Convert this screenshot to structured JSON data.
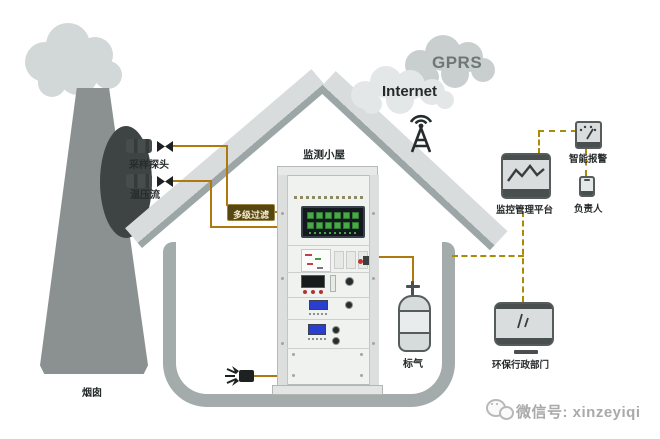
{
  "diagram_labels": {
    "chimney": "烟囱",
    "sampling_probe": "采样探头",
    "temp_pressure_flow": "温压流",
    "multi_stage_filter": "多级过滤",
    "monitoring_shelter": "监测小屋",
    "standard_gas": "标气",
    "gprs": "GPRS",
    "internet": "Internet",
    "monitoring_platform": "监控管理平台",
    "smart_alarm": "智能报警",
    "responsible_person": "负责人",
    "env_admin_department": "环保行政部门"
  },
  "watermark": {
    "text": "微信号: xinzeyiqi"
  },
  "icons": {
    "antenna": "signal-tower-with-waves",
    "monitoring_platform": "monitor-with-trend-line",
    "smart_alarm": "gauge-meter",
    "responsible_person": "smartphone",
    "env_admin_department": "desktop-monitor",
    "standard_gas": "gas-cylinder",
    "vent": "exhaust-valve",
    "probe_valve": "bowtie-valve",
    "watermark": "wechat-doodle"
  },
  "colors": {
    "pipe_solid": "#b0790f",
    "signal_dashed": "#ab8b06",
    "roof_light": "#d8dcdc",
    "roof_shadow": "#9ca6a6",
    "wall": "#a3abab",
    "chimney": "#8b9090",
    "smoke": "#d2d7d7",
    "device_outline": "#565c5c",
    "device_fill": "#d9dddd",
    "filter_box_bg": "#564612",
    "filter_box_text": "#f2e9ce",
    "screen_button_green": "#4aa84a",
    "lcd_blue": "#2a3fd0"
  }
}
